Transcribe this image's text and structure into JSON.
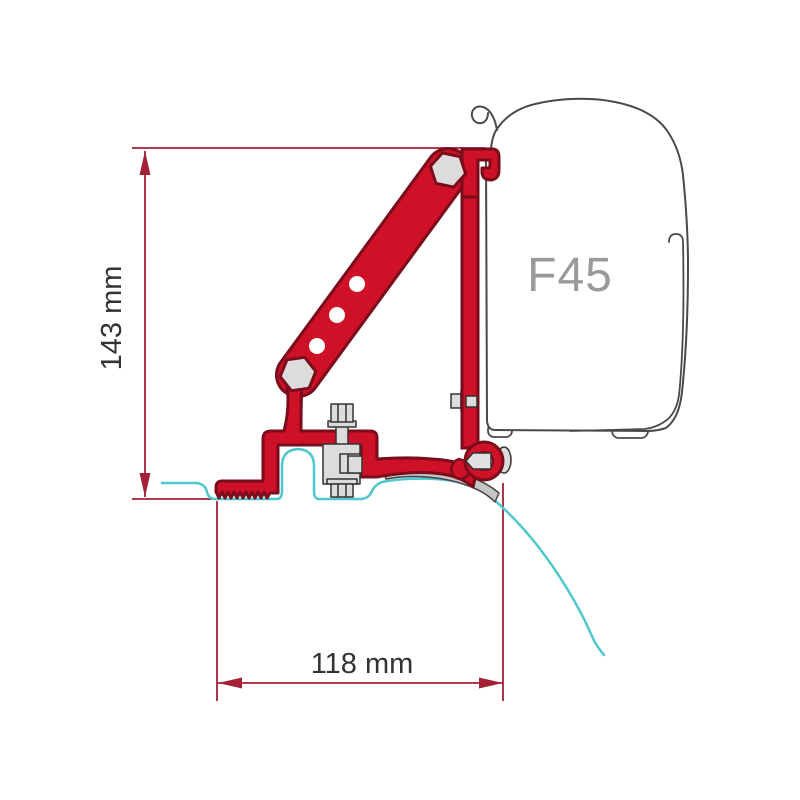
{
  "diagram": {
    "labels": {
      "height_dimension": "143 mm",
      "width_dimension": "118 mm",
      "awning_model": "F45"
    },
    "colors": {
      "background": "#ffffff",
      "bracket_red_fill": "#ce1126",
      "bracket_red_outline": "#7a0c1c",
      "dimension_line_red": "#a32036",
      "roof_profile_cyan": "#4ec7cd",
      "case_outline_gray": "#4a4a4a",
      "gutter_strip_gray": "#c6c6c6",
      "hardware_gray": "#dcdcdc",
      "model_label_gray": "#9a9a9a",
      "dimension_text_dark": "#333333"
    }
  }
}
